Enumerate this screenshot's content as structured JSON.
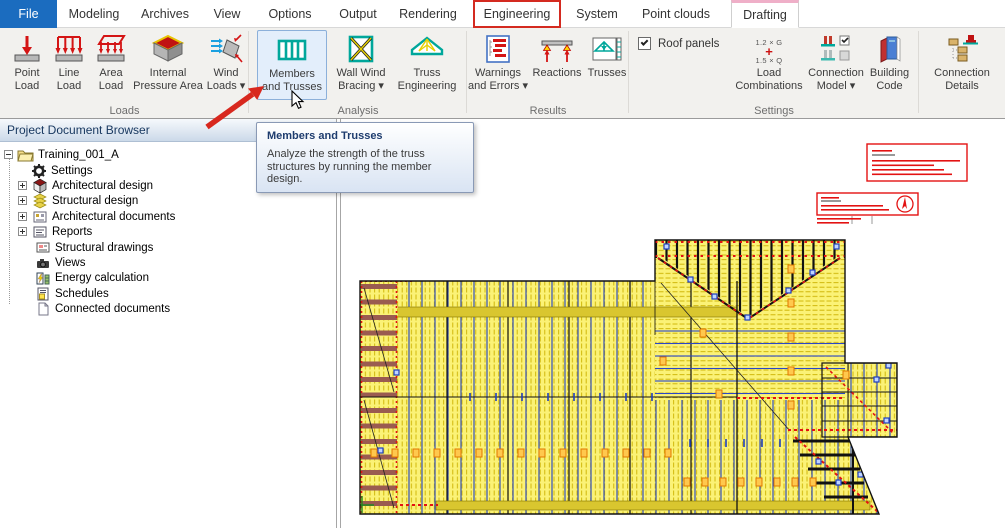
{
  "tab_bar": {
    "tabs": [
      "File",
      "Modeling",
      "Archives",
      "View",
      "Options",
      "Output",
      "Rendering",
      "Engineering",
      "System",
      "Point clouds",
      "Drafting"
    ]
  },
  "ribbon": {
    "group_labels": {
      "loads": "Loads",
      "analysis": "Analysis",
      "results": "Results",
      "settings": "Settings"
    },
    "buttons": {
      "point_load": {
        "line1": "Point",
        "line2": "Load"
      },
      "line_load": {
        "line1": "Line",
        "line2": "Load"
      },
      "area_load": {
        "line1": "Area",
        "line2": "Load"
      },
      "internal_pressure_area": {
        "line1": "Internal",
        "line2": "Pressure Area"
      },
      "wind_loads": {
        "line1": "Wind",
        "line2": "Loads ▾"
      },
      "members_and_trusses": {
        "line1": "Members",
        "line2": "and Trusses"
      },
      "wall_wind_bracing": {
        "line1": "Wall Wind",
        "line2": "Bracing ▾"
      },
      "truss_engineering": {
        "line1": "Truss",
        "line2": "Engineering"
      },
      "warnings_and_errors": {
        "line1": "Warnings",
        "line2": "and Errors ▾"
      },
      "reactions": {
        "label": "Reactions"
      },
      "trusses": {
        "label": "Trusses"
      },
      "load_combinations": {
        "line1": "Load",
        "line2": "Combinations",
        "icon_top": "1.2 × G",
        "icon_plus": "+",
        "icon_bottom": "1.5 × Q"
      },
      "connection_model": {
        "line1": "Connection",
        "line2": "Model ▾"
      },
      "building_code": {
        "line1": "Building",
        "line2": "Code"
      },
      "connection_details": {
        "line1": "Connection",
        "line2": "Details"
      }
    },
    "roof_panels_label": "Roof panels"
  },
  "tooltip": {
    "title": "Members and Trusses",
    "body": "Analyze the strength of the truss structures by running the member design."
  },
  "browser": {
    "title": "Project Document Browser",
    "root": "Training_001_A",
    "items": [
      "Settings",
      "Architectural design",
      "Structural design",
      "Architectural documents",
      "Reports",
      "Structural drawings",
      "Views",
      "Energy calculation",
      "Schedules",
      "Connected documents"
    ]
  },
  "colors": {
    "file_tab": "#1B6CBF",
    "annotation_red": "#D8281E",
    "icon_teal": "#00A79B",
    "plan_yellow": "#FBF276",
    "plan_blue": "#1F3FBF",
    "plan_red": "#E31212"
  }
}
